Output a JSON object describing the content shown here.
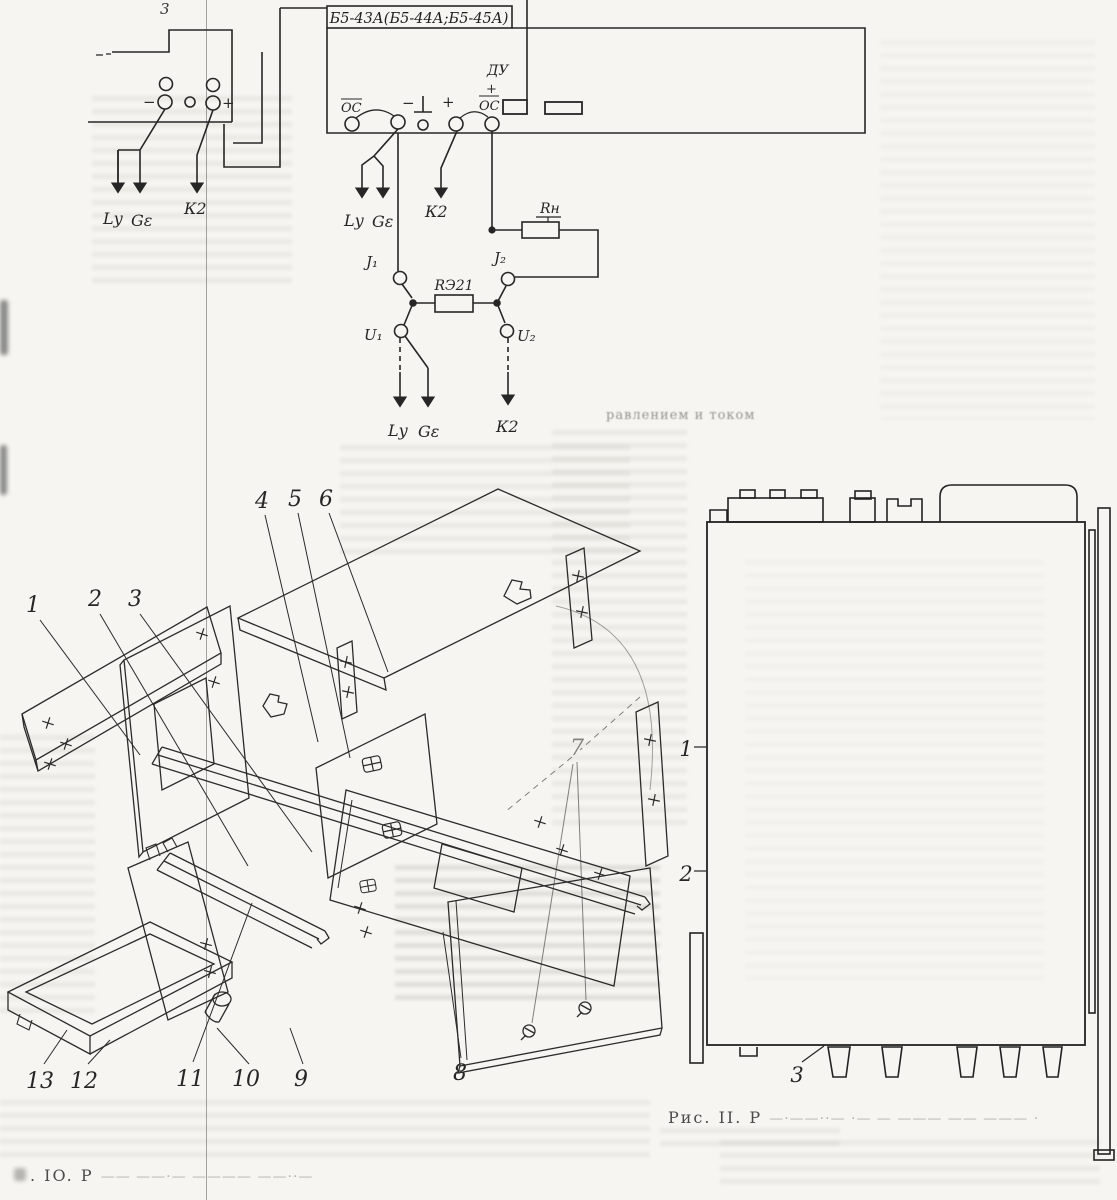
{
  "captions": {
    "fig10_label": ". IO. Р",
    "fig10_trail": "—— ——·—  ————  ——··—",
    "fig11_label": "Рис. II. Р",
    "fig11_trail": "—·——··—  ·—   — ———  ——  ——— ·"
  },
  "artifacts": {
    "bleed_fragment": "равлением и током"
  },
  "circuit": {
    "title": "Б5-43А(Б5-44А;Б5-45А)",
    "left_unit": {
      "partial_top_label": "3",
      "minus": "−",
      "plus": "+",
      "arrows": {
        "lu": "Lу",
        "ge": "Gε",
        "k2": "К2"
      }
    },
    "main_unit": {
      "os_left": "ОС",
      "minus": "−",
      "plus": "+",
      "os_right": "ОС",
      "du": "ДУ",
      "du_plus": "+"
    },
    "mid_arrows": {
      "lu": "Lу",
      "ge": "Gε",
      "k2": "К2"
    },
    "bottom_arrows": {
      "lu": "Lу",
      "ge": "Gε",
      "k2": "К2"
    },
    "network": {
      "j1": "J₁",
      "j2": "J₂",
      "u1": "U₁",
      "u2": "U₂",
      "r21": "RЭ21",
      "rn": "Rн"
    }
  },
  "exploded": {
    "callouts": [
      "1",
      "2",
      "3",
      "4",
      "5",
      "6",
      "7",
      "8",
      "9",
      "10",
      "11",
      "12",
      "13"
    ]
  },
  "side_view": {
    "callouts": {
      "c1": "1",
      "c2": "2",
      "c3": "3"
    }
  }
}
